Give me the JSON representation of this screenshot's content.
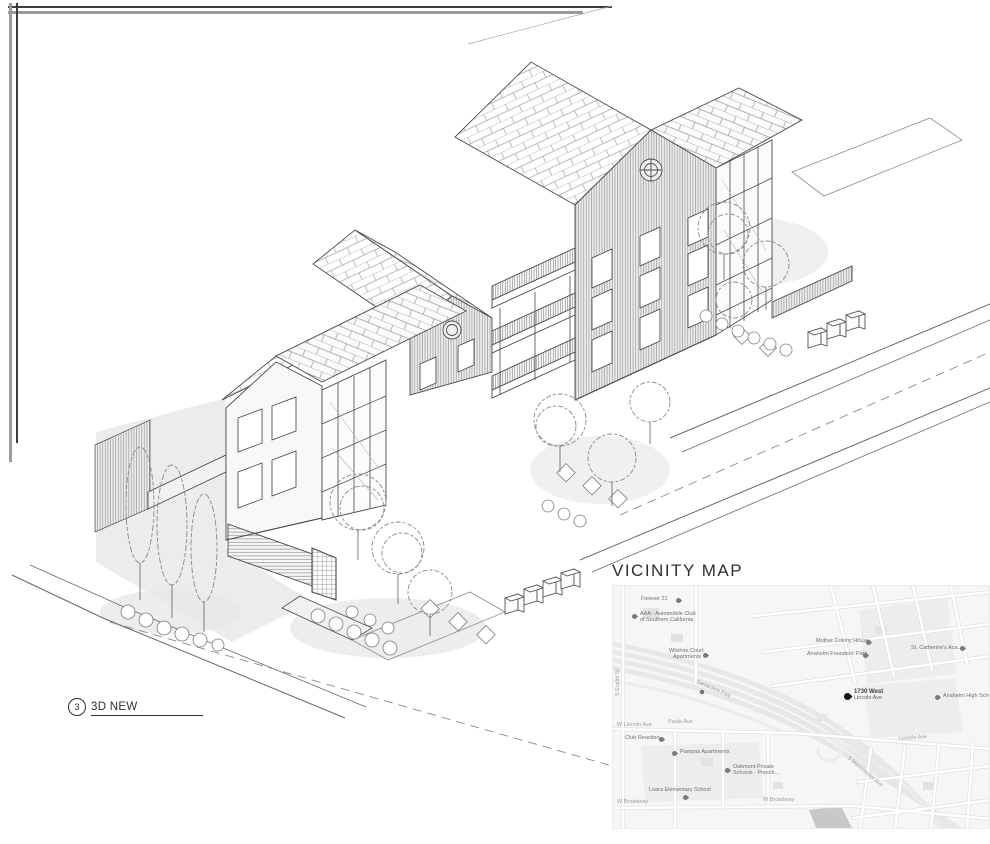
{
  "sheet": {
    "drawing_callout": {
      "number": "3",
      "title": "3D NEW"
    },
    "map_title": "VICINITY MAP"
  },
  "map": {
    "streets": [
      "W Lincoln Ave",
      "Paula Ave",
      "Lincoln Ave",
      "W Broadway",
      "W Broadway",
      "S Euclid St",
      "Santa Ana Fwy",
      "S Manchester Ave"
    ],
    "pois": [
      {
        "label": "Forever 21"
      },
      {
        "label": "AAA - Automobile Club",
        "line2": "of Southern California"
      },
      {
        "label": "Mother Colony House"
      },
      {
        "label": "Anaheim Founders' Park"
      },
      {
        "label": "Wilshire Court",
        "line2": "Apartments"
      },
      {
        "label": "St. Catherine's Aca..."
      },
      {
        "label": "Anaheim High School"
      },
      {
        "label": "Club Reaction"
      },
      {
        "label": "Pampas Apartments"
      },
      {
        "label": "Oakmont Private",
        "line2": "Schools - Presch..."
      },
      {
        "label": "Loara Elementary School"
      }
    ],
    "site_pin": {
      "line1": "1730 West",
      "line2": "Lincoln Ave"
    }
  },
  "colors": {
    "ink": "#3f3f3f",
    "shadow": "#e9e9e9",
    "map_bg": "#f6f6f5",
    "map_road": "#ffffff",
    "map_casing": "#e0e0e0",
    "site_pin": "#141414"
  }
}
